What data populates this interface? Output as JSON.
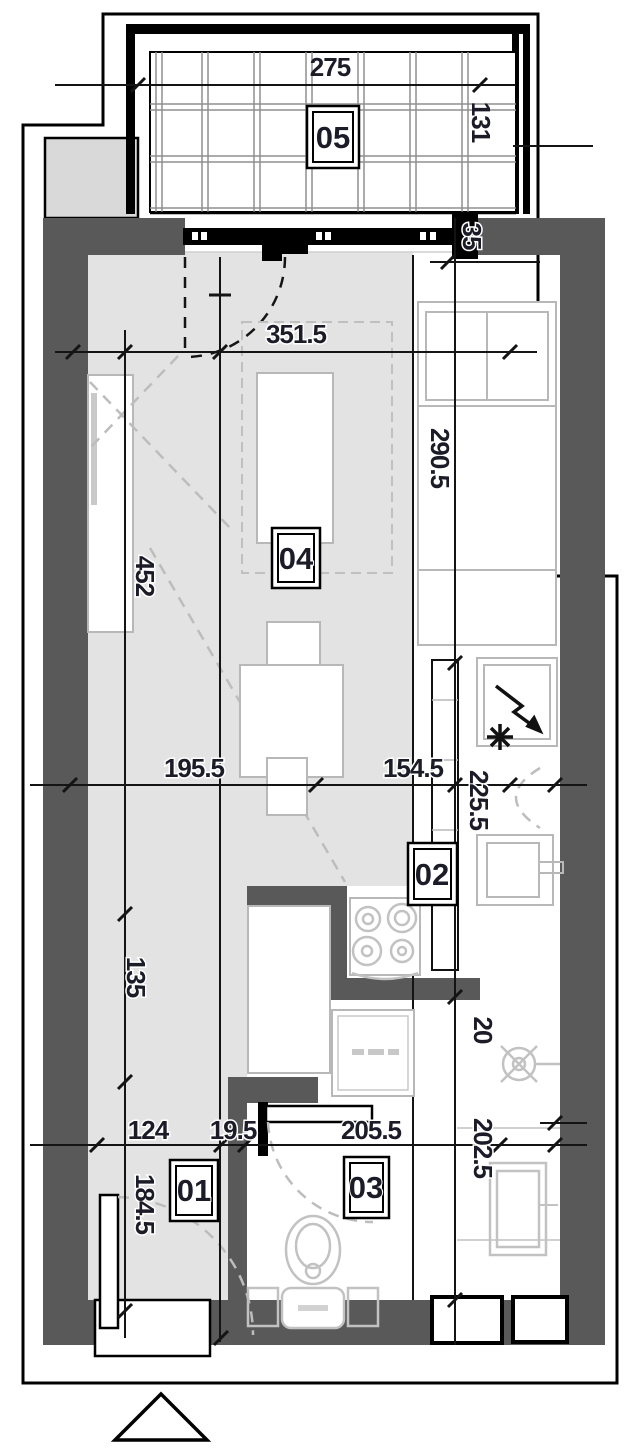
{
  "colors": {
    "wall": "#595959",
    "floor": "#e3e3e3",
    "neighbor_block": "#d9d9d9",
    "furniture": "#b8b8b8",
    "fixture": "#c2c2c2",
    "ink": "#1c1c28",
    "dash": "#bdbdbd",
    "grid": "#8f8f8f"
  },
  "plan": {
    "rooms": [
      {
        "id": "05"
      },
      {
        "id": "04"
      },
      {
        "id": "02"
      },
      {
        "id": "03"
      },
      {
        "id": "01"
      }
    ],
    "dims": [
      {
        "text": "275",
        "orientation": "h"
      },
      {
        "text": "131",
        "orientation": "v"
      },
      {
        "text": "35",
        "orientation": "v"
      },
      {
        "text": "351.5",
        "orientation": "h"
      },
      {
        "text": "290.5",
        "orientation": "v"
      },
      {
        "text": "452",
        "orientation": "v"
      },
      {
        "text": "195.5",
        "orientation": "h"
      },
      {
        "text": "154.5",
        "orientation": "h"
      },
      {
        "text": "225.5",
        "orientation": "v"
      },
      {
        "text": "135",
        "orientation": "v"
      },
      {
        "text": "20",
        "orientation": "v"
      },
      {
        "text": "124",
        "orientation": "h"
      },
      {
        "text": "19.5",
        "orientation": "h"
      },
      {
        "text": "205.5",
        "orientation": "h"
      },
      {
        "text": "202.5",
        "orientation": "v"
      },
      {
        "text": "184.5",
        "orientation": "v"
      }
    ]
  }
}
